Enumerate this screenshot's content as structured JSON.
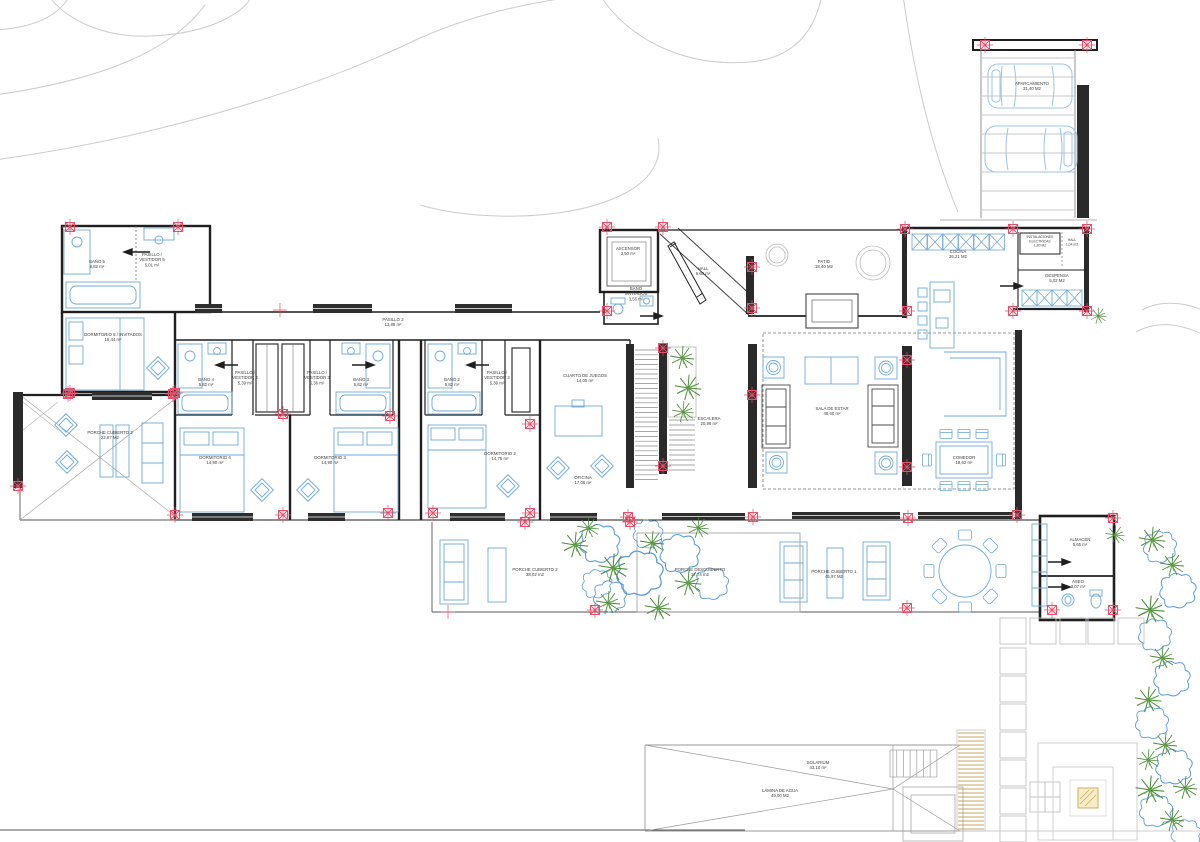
{
  "drawing": {
    "kind": "architectural floor plan",
    "language": "Spanish",
    "background": "#ffffff"
  },
  "colors": {
    "wall": "#1f1f1f",
    "thin_line": "#555555",
    "furniture_blue": "#6fa9d6",
    "sofa_dark": "#4a4a4a",
    "grid_marker_red": "#e8506b",
    "plant_green": "#4b8a3a",
    "bush_blue": "#5b9bd5",
    "contour_gray": "#cccccc",
    "hardscape_gray": "#c2c2c2",
    "deck_tan": "#c5a45f",
    "accent_tan_fill": "#f6ecc9",
    "label_text": "#3d3d3d"
  },
  "icons": {
    "grid_marker": "structural-grid-registration-mark (red square with X and cross ticks)",
    "plant": "plant-starburst",
    "bush": "shrub-cloud-outline"
  },
  "rooms": [
    {
      "lines": [
        "BAÑO 5",
        "5,82 m²"
      ],
      "x": 97,
      "y": 263
    },
    {
      "lines": [
        "PASILLO /",
        "VESTIDOR 5",
        "5,01 m²"
      ],
      "x": 152,
      "y": 256
    },
    {
      "lines": [
        "DORMITORIO 5 / INVITADOS",
        "16,44 m²"
      ],
      "x": 113,
      "y": 336
    },
    {
      "lines": [
        "PASILLO 2",
        "13,88 m²"
      ],
      "x": 393,
      "y": 321
    },
    {
      "lines": [
        "BAÑO 4",
        "5,82 m²"
      ],
      "x": 206,
      "y": 381
    },
    {
      "lines": [
        "PASILLO /",
        "VESTIDOR 4",
        "5,39 m²"
      ],
      "x": 245,
      "y": 374
    },
    {
      "lines": [
        "PASILLO /",
        "VESTIDOR 3",
        "5,36 m²"
      ],
      "x": 317,
      "y": 374
    },
    {
      "lines": [
        "BAÑO 3",
        "5,82 m²"
      ],
      "x": 361,
      "y": 381
    },
    {
      "lines": [
        "DORMITORIO 4",
        "14,90 m²"
      ],
      "x": 215,
      "y": 459
    },
    {
      "lines": [
        "DORMITORIO 3",
        "14,90 m²"
      ],
      "x": 330,
      "y": 459
    },
    {
      "lines": [
        "BAÑO 2",
        "5,82 m²"
      ],
      "x": 452,
      "y": 381
    },
    {
      "lines": [
        "PASILLO /",
        "VESTIDOR 2",
        "5,39 m²"
      ],
      "x": 497,
      "y": 374
    },
    {
      "lines": [
        "DORMITORIO 2",
        "14,75 m²"
      ],
      "x": 500,
      "y": 455
    },
    {
      "lines": [
        "CUARTO DE JUEGOS",
        "14,05 m²"
      ],
      "x": 585,
      "y": 377
    },
    {
      "lines": [
        "OFICINA",
        "17,06 m²"
      ],
      "x": 583,
      "y": 479
    },
    {
      "lines": [
        "ESCALERA",
        "20,99 m²"
      ],
      "x": 709,
      "y": 420
    },
    {
      "lines": [
        "ASCENSOR",
        "3,50 m²"
      ],
      "x": 628,
      "y": 250
    },
    {
      "lines": [
        "BAÑO",
        "INVITADOS",
        "3,55 m²"
      ],
      "x": 636,
      "y": 290
    },
    {
      "lines": [
        "HALL",
        "6,60 m²"
      ],
      "x": 703,
      "y": 270
    },
    {
      "lines": [
        "PATIO",
        "18,40 M2"
      ],
      "x": 824,
      "y": 263
    },
    {
      "lines": [
        "COCINA",
        "26,21 M2"
      ],
      "x": 958,
      "y": 253
    },
    {
      "lines": [
        "INSTALACIONES",
        "ELECTRICAS",
        "1,80 M2"
      ],
      "x": 1040,
      "y": 238,
      "size": 3.4
    },
    {
      "lines": [
        "HALL",
        "1,04 m2"
      ],
      "x": 1072,
      "y": 241,
      "size": 3.4
    },
    {
      "lines": [
        "DESPENSA",
        "5,02 M2"
      ],
      "x": 1057,
      "y": 277
    },
    {
      "lines": [
        "SALA DE ESTAR",
        "48,60 m²"
      ],
      "x": 832,
      "y": 410
    },
    {
      "lines": [
        "COMEDOR",
        "18,62 m²"
      ],
      "x": 964,
      "y": 459
    },
    {
      "lines": [
        "PORCHE CUBIERTO 3",
        "22,87 M2"
      ],
      "x": 110,
      "y": 434
    },
    {
      "lines": [
        "PORCHE CUBIERTO 2",
        "38,02 m2"
      ],
      "x": 535,
      "y": 571
    },
    {
      "lines": [
        "PORCHE DESCUBIERTO",
        "17,74 m2"
      ],
      "x": 700,
      "y": 571
    },
    {
      "lines": [
        "PORCHE CUBIERTO 1",
        "45,97 M2"
      ],
      "x": 834,
      "y": 573
    },
    {
      "lines": [
        "ALMACÉN",
        "5,65 m²"
      ],
      "x": 1080,
      "y": 541
    },
    {
      "lines": [
        "ASEO",
        "3,07 m²"
      ],
      "x": 1078,
      "y": 583
    },
    {
      "lines": [
        "SOLARIUM",
        "43,10 m²"
      ],
      "x": 818,
      "y": 764
    },
    {
      "lines": [
        "LÁMINA DE AGUA",
        "49,00 M2"
      ],
      "x": 780,
      "y": 792
    },
    {
      "lines": [
        "APARCAMIENTO",
        "31,40 M2"
      ],
      "x": 1032,
      "y": 85
    }
  ]
}
